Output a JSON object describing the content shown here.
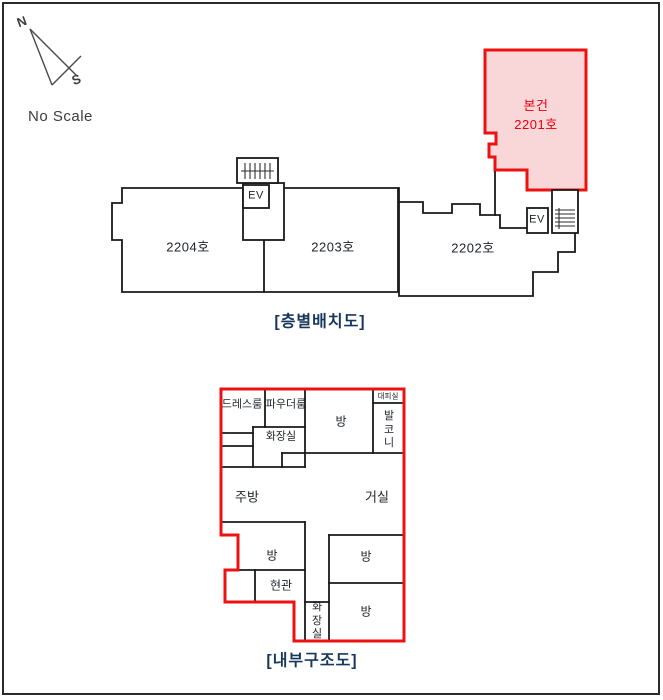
{
  "document": {
    "type": "floor-plan-sheet"
  },
  "compass": {
    "north": "N",
    "south": "S",
    "no_scale": "No Scale"
  },
  "colors": {
    "highlight_fill": "#f9d6d7",
    "highlight_stroke": "#ee1111",
    "wall": "#1a1a1a",
    "title": "#17375d",
    "subject_text": "#e8000f",
    "ink": "#20242e"
  },
  "floor_plan": {
    "title": "[층별배치도]",
    "elevator_label": "EV",
    "units": [
      {
        "label": "2204호"
      },
      {
        "label": "2203호"
      },
      {
        "label": "2202호"
      }
    ],
    "subject": {
      "name": "본건",
      "unit": "2201호"
    }
  },
  "interior": {
    "title": "[내부구조도]",
    "rooms": [
      {
        "label": "드레스룸"
      },
      {
        "label": "파우더룸"
      },
      {
        "label": "화장실"
      },
      {
        "label": "방"
      },
      {
        "label": "대피실"
      },
      {
        "label": "발코니"
      },
      {
        "label": "주방"
      },
      {
        "label": "거실"
      },
      {
        "label": "방"
      },
      {
        "label": "현관"
      },
      {
        "label": "화장실"
      },
      {
        "label": "방"
      },
      {
        "label": "방"
      }
    ]
  }
}
